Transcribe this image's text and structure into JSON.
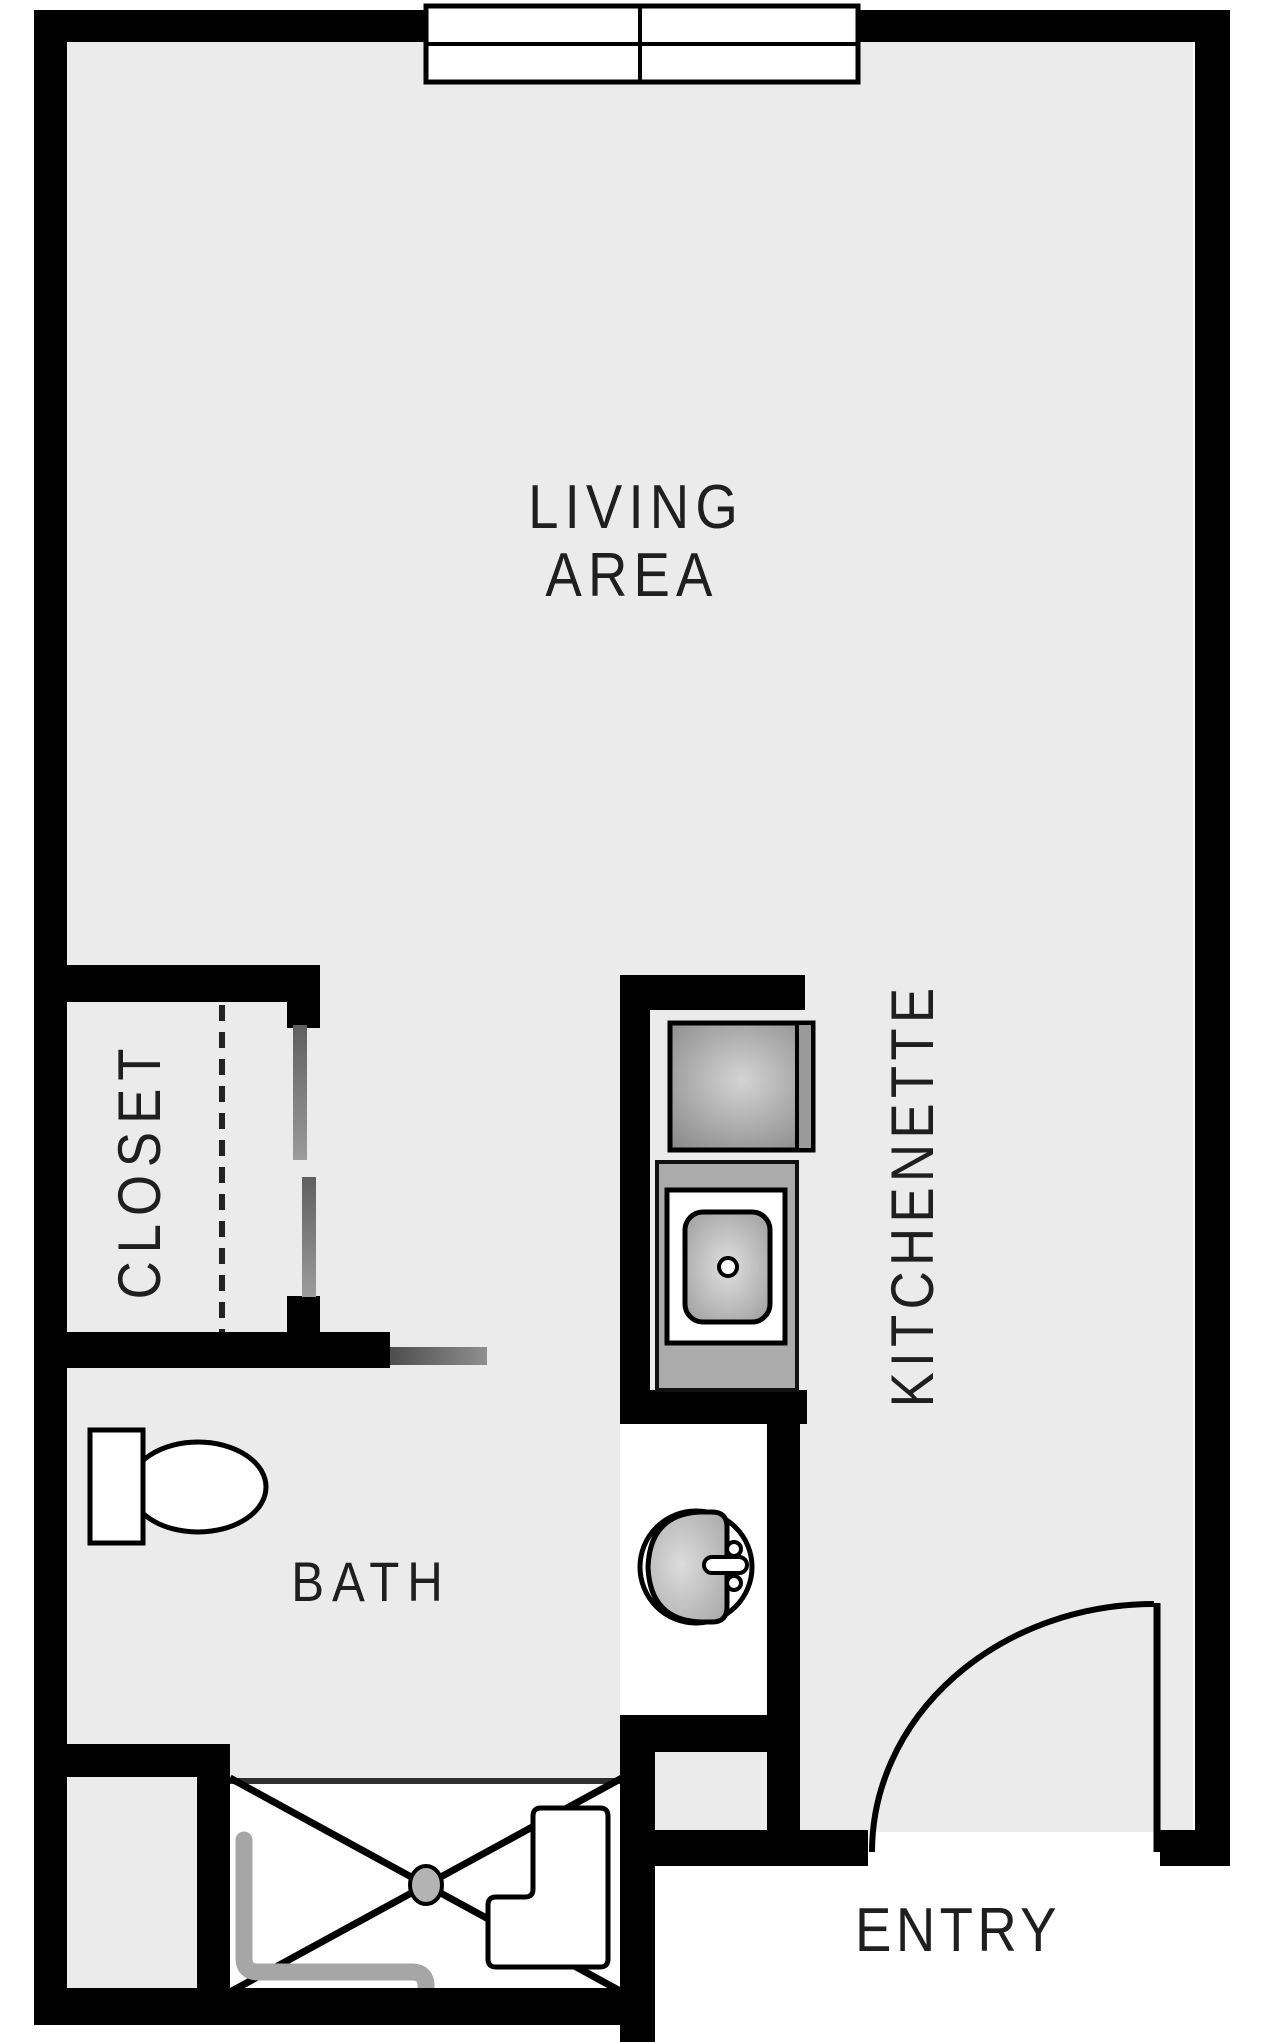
{
  "floorplan": {
    "rooms": {
      "living": {
        "label_line1": "LIVING",
        "label_line2": "AREA"
      },
      "closet": {
        "label": "CLOSET"
      },
      "kitchenette": {
        "label": "KITCHENETTE"
      },
      "bath": {
        "label": "BATH"
      },
      "entry": {
        "label": "ENTRY"
      }
    },
    "fixtures": [
      "window",
      "sliding-closet-doors",
      "pocket-door",
      "range",
      "kitchen-sink",
      "bathroom-sink",
      "toilet",
      "shower",
      "shower-bench",
      "grab-bar",
      "floor-drain",
      "entry-door-swing"
    ],
    "colors": {
      "wall": "#000000",
      "floor": "#ebebeb",
      "outside": "#ffffff",
      "counter_gray": "#ababab",
      "appliance_gray": "#9a9a9a",
      "door_panel_gray": "#7a7a7a",
      "grab_bar_gray": "#a6a6a6",
      "drain_gray": "#b3b3b3",
      "label_text": "#1f1f1f"
    }
  }
}
